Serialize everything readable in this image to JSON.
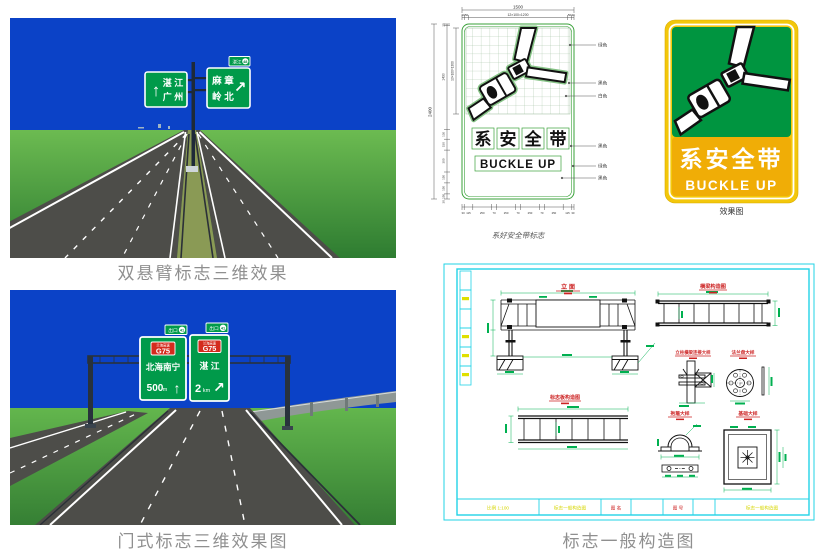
{
  "captions": {
    "cantilever": "双悬臂标志三维效果",
    "gantry": "门式标志三维效果图"
  },
  "scene1": {
    "sign_left": {
      "arrow": "↑",
      "dest1": "湛 江",
      "dest2": "广 州"
    },
    "sign_right": {
      "dest1": "麻 章",
      "dest2": "岭 北",
      "arrow": "↗",
      "plate": "湛江",
      "plate_num": "48"
    }
  },
  "scene2": {
    "exit_plate": "出口",
    "exit_num": "41",
    "sign_left": {
      "route_top": "兰海高速",
      "route": "G75",
      "dest": "北海南宁",
      "dist": "500",
      "unit": "m",
      "arrow": "↑"
    },
    "sign_right": {
      "route_top": "兰海高速",
      "route": "G75",
      "dest": "湛 江",
      "dist": "2",
      "unit": "km",
      "arrow": "↗"
    }
  },
  "tech": {
    "caption": "系好安全带标志",
    "width_total": "1500",
    "top_dims": [
      "30",
      "50",
      "12×100=1200",
      "50",
      "30"
    ],
    "height_total": "2400",
    "left_dims": {
      "a": "20",
      "b": "1430",
      "grid": "13×100=1300",
      "c": "130",
      "d": "150",
      "e": "300",
      "f": "150",
      "g": "150",
      "h": "150",
      "i": "30"
    },
    "bottom_dims": [
      "30",
      "115",
      "250",
      "70",
      "250",
      "70",
      "250",
      "70",
      "250",
      "115",
      "30"
    ],
    "callouts": [
      "绿色",
      "黑色",
      "白色",
      "黑色",
      "绿色",
      "黑色"
    ],
    "chars": [
      "系",
      "安",
      "全",
      "带"
    ],
    "line2": "BUCKLE UP"
  },
  "render_sign": {
    "line1": "系安全带",
    "line2": "BUCKLE UP",
    "caption": "效果图"
  },
  "cad": {
    "caption": "标志一般构造图",
    "views": {
      "elevation": "立 面",
      "beam": "横梁构造图",
      "connection": "立柱横梁连接大样",
      "flange": "法兰盘大样",
      "panel_beam": "标志板构造图",
      "clamp": "抱箍大样",
      "foundation": "基础大样"
    },
    "titleblock": {
      "c0": "比例 1:100",
      "c1": "标志一般构造图",
      "c2": "图 名",
      "c4": "图 号",
      "c6": "标志一般构造图"
    }
  },
  "colors": {
    "sky": "#0b42c7",
    "sign_green": "#009a4a",
    "road": "#4d4d49",
    "cad_frame": "#22d3e6",
    "dim_green": "#00b050",
    "title_red": "#cc2222",
    "render_yellow": "#f3c70b",
    "render_green": "#009540"
  }
}
